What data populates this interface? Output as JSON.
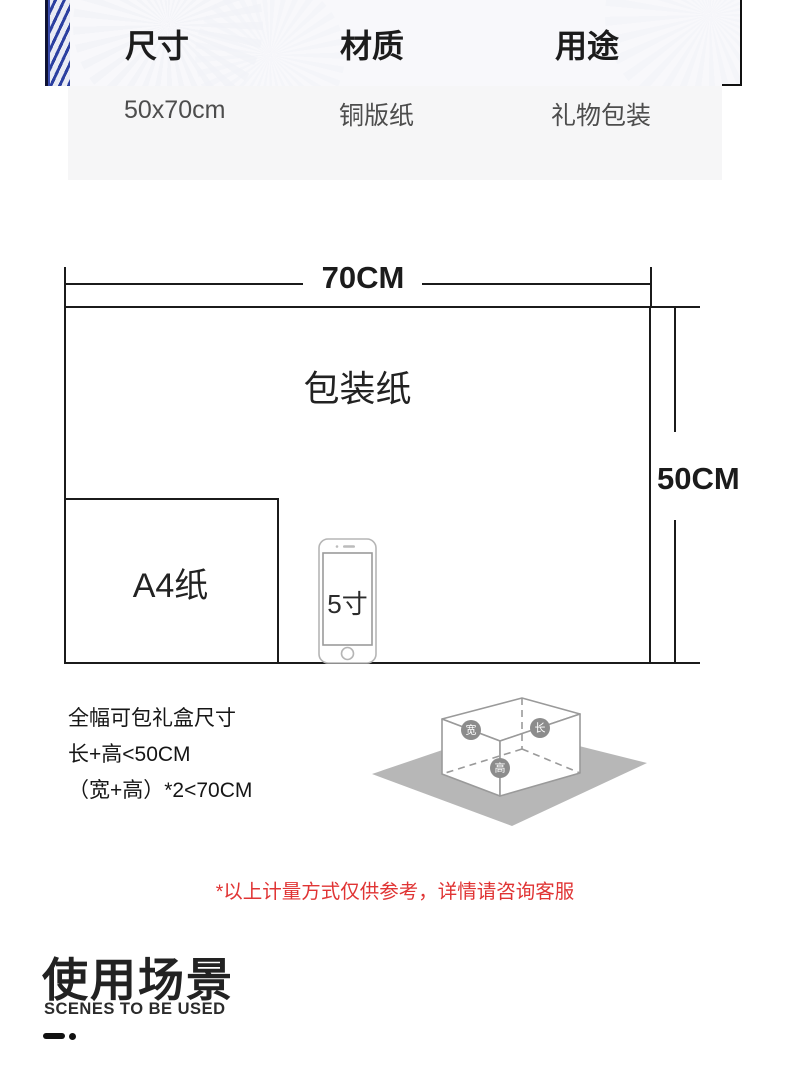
{
  "spec_table": {
    "columns": [
      {
        "label": "尺寸",
        "value": "50x70cm"
      },
      {
        "label": "材质",
        "value": "铜版纸"
      },
      {
        "label": "用途",
        "value": "礼物包装"
      }
    ]
  },
  "dimension_diagram": {
    "width_label": "70CM",
    "height_label": "50CM",
    "paper_label": "包装纸",
    "a4_label": "A4纸",
    "phone_label": "5寸"
  },
  "giftbox_guide": {
    "lines": [
      "全幅可包礼盒尺寸",
      "长+高<50CM",
      "（宽+高）*2<70CM"
    ],
    "badges": [
      {
        "label": "宽"
      },
      {
        "label": "长"
      },
      {
        "label": "高"
      }
    ]
  },
  "note": {
    "text": "*以上计量方式仅供参考，详情请咨询客服"
  },
  "section_header": {
    "title": "使用场景",
    "subtitle": "SCENES TO BE USED"
  },
  "colors": {
    "note_red": "#e03434",
    "line_dark": "#1b1b1b",
    "panel_gray": "#f6f6f7",
    "roll_blue": "#2b3fa0",
    "ground_gray": "#b7b7b7"
  }
}
